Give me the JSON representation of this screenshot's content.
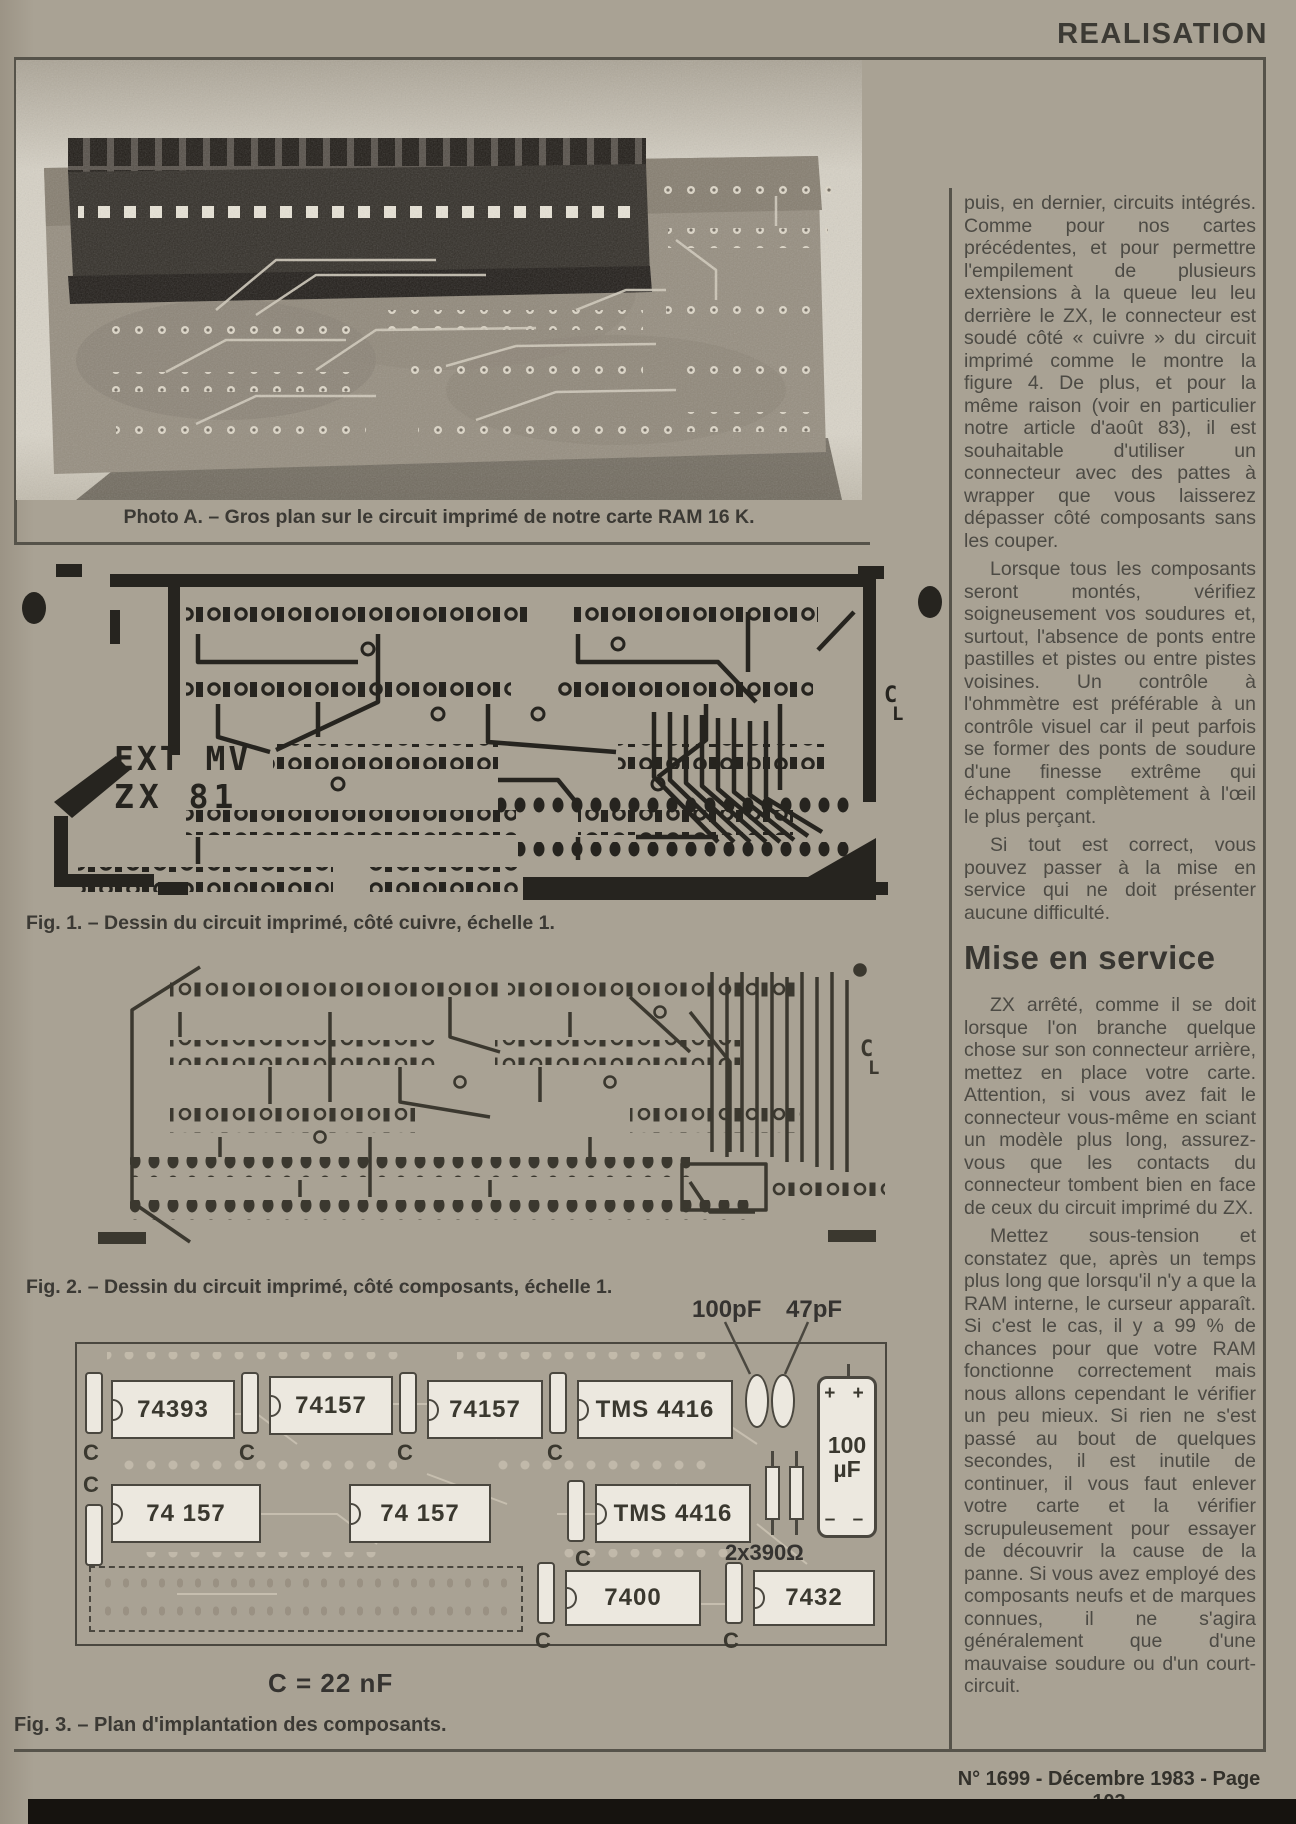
{
  "header": {
    "label": "REALISATION"
  },
  "photo": {
    "caption": "Photo A. – Gros plan sur le circuit imprimé de notre carte RAM 16 K."
  },
  "fig1": {
    "caption": "Fig. 1. – Dessin du circuit imprimé, côté cuivre, échelle 1.",
    "board_text": {
      "line1": "EXT MV",
      "line2": "ZX 81"
    },
    "mark_c": "C",
    "mark_l": "L"
  },
  "fig2": {
    "caption": "Fig. 2. – Dessin du circuit imprimé, côté composants, échelle 1.",
    "mark_c": "C",
    "mark_l": "L"
  },
  "fig3": {
    "caption": "Fig. 3. – Plan d'implantation des composants.",
    "cap_formula": "C = 22 nF",
    "pointer_labels": {
      "cap100": "100pF",
      "cap47": "47pF"
    },
    "resistor_label": "2x390Ω",
    "electrolytic": {
      "plus": "+ +",
      "value": "100",
      "unit": "µF",
      "minus": "– –"
    },
    "c_label": "C",
    "row1": [
      "74393",
      "74157",
      "74157",
      "TMS 4416"
    ],
    "row2": [
      "74 157",
      "74 157",
      "TMS 4416"
    ],
    "row3": [
      "7400",
      "7432"
    ]
  },
  "article": {
    "paragraphs_top": [
      "puis, en dernier, circuits intégrés. Comme pour nos cartes précédentes, et pour permettre l'empilement de plusieurs extensions à la queue leu leu derrière le ZX, le connecteur est soudé côté « cuivre » du circuit imprimé comme le montre la figure 4. De plus, et pour la même raison (voir en particulier notre article d'août 83), il est souhaitable d'utiliser un connecteur avec des pattes à wrapper que vous laisserez dépasser côté composants sans les couper.",
      "Lorsque tous les composants seront montés, vérifiez soigneusement vos soudures et, surtout, l'absence de ponts entre pastilles et pistes ou entre pistes voisines. Un contrôle à l'ohmmètre est préférable à un contrôle visuel car il peut parfois se former des ponts de soudure d'une finesse extrême qui échappent complètement à l'œil le plus perçant.",
      "Si tout est correct, vous pouvez passer à la mise en service qui ne doit présenter aucune difficulté."
    ],
    "heading": "Mise en service",
    "paragraphs_bottom": [
      "ZX arrêté, comme il se doit lorsque l'on branche quelque chose sur son connecteur arrière, mettez en place votre carte. Attention, si vous avez fait le connecteur vous-même en sciant un modèle plus long, assurez-vous que les contacts du connecteur tombent bien en face de ceux du circuit imprimé du ZX.",
      "Mettez sous-tension et constatez que, après un temps plus long que lorsqu'il n'y a que la RAM interne, le curseur apparaît. Si c'est le cas, il y a 99 % de chances pour que votre RAM fonctionne correctement mais nous allons cependant le vérifier un peu mieux. Si rien ne s'est passé au bout de quelques secondes, il est inutile de continuer, il vous faut enlever votre carte et la vérifier scrupuleusement pour essayer de découvrir la cause de la panne. Si vous avez employé des composants neufs et de marques connues, il ne s'agira généralement que d'une mauvaise soudure ou d'un court-circuit."
    ]
  },
  "footer": {
    "label": "N° 1699 - Décembre 1983 - Page 103"
  }
}
